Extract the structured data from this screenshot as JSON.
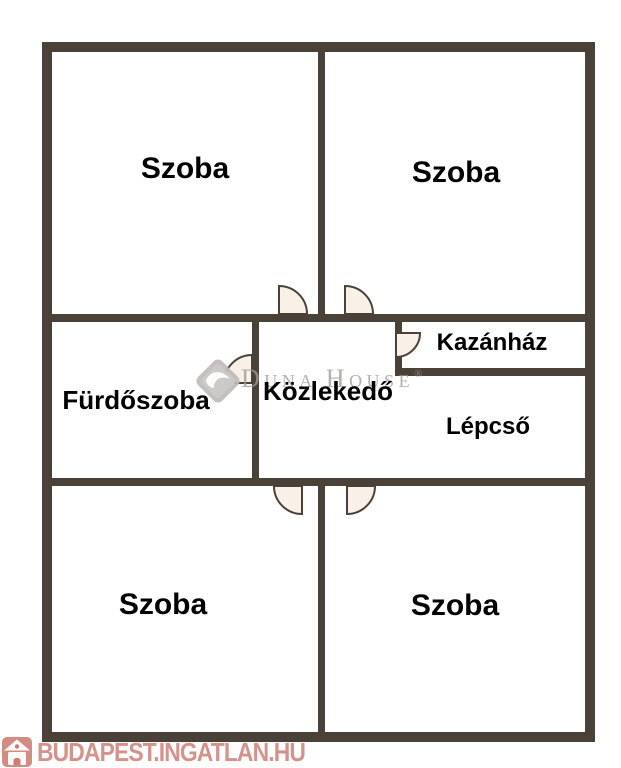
{
  "title": "Floor plan",
  "colors": {
    "wall": "#4a4138",
    "door_fill": "#f9f1e7",
    "door_stroke": "#4a4138",
    "room_label": "#000000",
    "watermark_gray": "#9e9a96",
    "brand_red": "#cb7d72"
  },
  "rooms": [
    {
      "id": "szoba-top-left",
      "label": "Szoba"
    },
    {
      "id": "szoba-top-right",
      "label": "Szoba"
    },
    {
      "id": "furdoszoba",
      "label": "Fürdőszoba"
    },
    {
      "id": "kozlekedo",
      "label": "Közlekedő"
    },
    {
      "id": "kazanhaz",
      "label": "Kazánház"
    },
    {
      "id": "lepcso",
      "label": "Lépcső"
    },
    {
      "id": "szoba-bottom-left",
      "label": "Szoba"
    },
    {
      "id": "szoba-bottom-right",
      "label": "Szoba"
    }
  ],
  "watermark": {
    "brand_part1_initial": "D",
    "brand_part1_rest": "UNA",
    "brand_part2_initial": "H",
    "brand_part2_rest": "OUSE",
    "registered_mark": "®"
  },
  "footer": {
    "site_text": "BUDAPEST.INGATLAN.HU"
  }
}
